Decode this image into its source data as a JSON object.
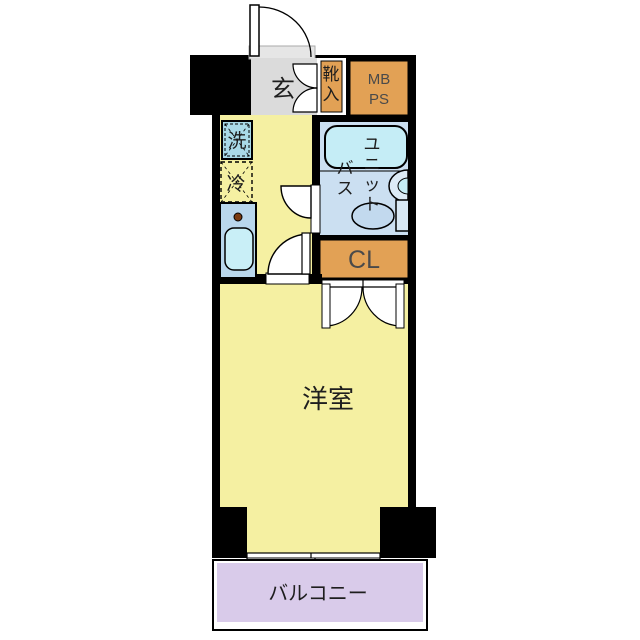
{
  "plan": {
    "type": "apartment-floor-plan"
  },
  "colors": {
    "wall": "#000000",
    "floor": "#F5F0A2",
    "genkan_floor": "#DBDBDB",
    "threshold": "#E6E6E6",
    "storage": "#E2A155",
    "bath_floor": "#CBDFF1",
    "bathtub": "#C5EDF6",
    "basin": "#DCEBF6",
    "toilet": "#C2D9EE",
    "tank": "#D8E8F4",
    "counter": "#B9D7EC",
    "kitchen_sink": "#C9EFF7",
    "washer_box": "#A9DAE8",
    "burner": "#7A3A10",
    "balcony_floor": "#D9CBEA",
    "door": "#FFFFFF",
    "label": "#1E1E1E",
    "label_muted": "#4A4A4A"
  },
  "rooms": {
    "entrance": {
      "label": "玄"
    },
    "shoe_cabinet": {
      "label": "靴入"
    },
    "meter_box": {
      "line1": "MB",
      "line2": "PS"
    },
    "washer": {
      "label": "洗"
    },
    "fridge": {
      "label": "冷"
    },
    "unit_bath": {
      "label_right": "ユニット",
      "label_left": "バス"
    },
    "closet": {
      "label": "CL"
    },
    "main_room": {
      "label": "洋室"
    },
    "balcony": {
      "label": "バルコニー"
    }
  }
}
